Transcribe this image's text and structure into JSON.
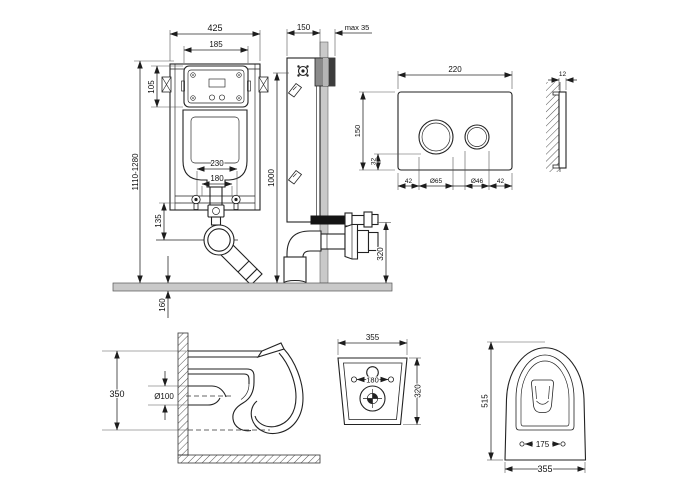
{
  "sheet": {
    "line_color": "#222222",
    "floor_fill": "#c9c9c9",
    "wall_fill": "#c9c9c9",
    "panel_dark": "#3c3c3c",
    "panel_mid": "#8a8a8a",
    "panel_light": "#b5b5b5"
  },
  "frame_front": {
    "width": "425",
    "access_box_width": "185",
    "access_box_height": "105",
    "install_height": "1110-1280",
    "bend_width": "230",
    "bolt_spacing": "180",
    "outlet_offset": "135",
    "below_floor": "160"
  },
  "frame_side": {
    "depth": "150",
    "finish_thickness": "max 35",
    "panel_height": "1000",
    "outlet_height": "320"
  },
  "flush_plate": {
    "width": "220",
    "height": "150",
    "button_offset": "32",
    "margin_left": "42",
    "button_large": "Ø65",
    "button_small": "Ø46",
    "margin_right": "42",
    "thickness": "12"
  },
  "bowl_side": {
    "height": "350",
    "drain": "Ø100"
  },
  "bowl_back": {
    "width": "355",
    "bolt_spacing": "180",
    "height": "320"
  },
  "bowl_top": {
    "depth": "515",
    "bolt_spacing": "175",
    "width": "355"
  }
}
